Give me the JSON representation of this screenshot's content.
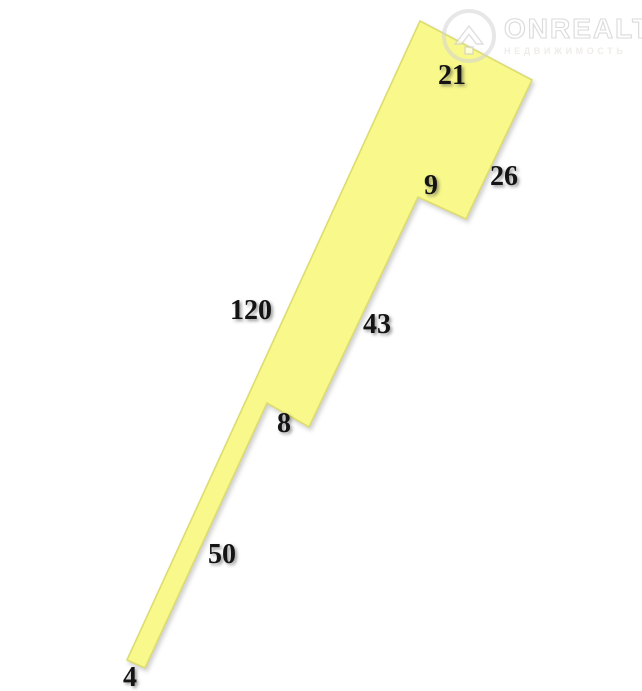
{
  "canvas": {
    "width": 642,
    "height": 691,
    "background": "#ffffff"
  },
  "watermark": {
    "brand": "ONREALT",
    "tagline": "НЕДВИЖИМОСТЬ",
    "logo_icon": "house-pin-icon",
    "ring_color": "#d3d3d3",
    "text_color": "#ffffff",
    "outline_color": "#cfcfcf"
  },
  "parcel": {
    "fill": "#f9f98b",
    "stroke": "#dcdc70",
    "label_color": "#141414",
    "vertices": [
      [
        420,
        21
      ],
      [
        532,
        80
      ],
      [
        466,
        219
      ],
      [
        418,
        197
      ],
      [
        309,
        427
      ],
      [
        267,
        403
      ],
      [
        145,
        668
      ],
      [
        127,
        660
      ]
    ],
    "side_labels": [
      {
        "text": "21",
        "x": 452,
        "y": 76
      },
      {
        "text": "26",
        "x": 504,
        "y": 177
      },
      {
        "text": "9",
        "x": 431,
        "y": 186
      },
      {
        "text": "43",
        "x": 377,
        "y": 325
      },
      {
        "text": "120",
        "x": 251,
        "y": 311
      },
      {
        "text": "8",
        "x": 284,
        "y": 424
      },
      {
        "text": "50",
        "x": 222,
        "y": 555
      },
      {
        "text": "4",
        "x": 130,
        "y": 678
      }
    ]
  }
}
